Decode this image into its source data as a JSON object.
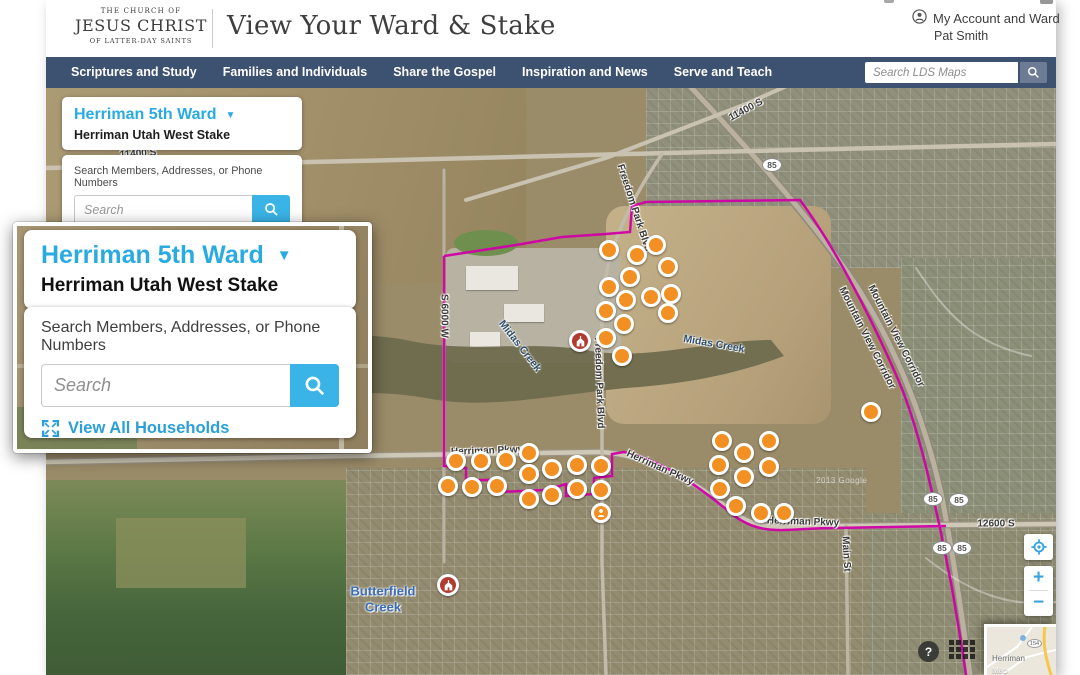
{
  "header": {
    "logo_line1": "THE CHURCH OF",
    "logo_line2": "JESUS CHRIST",
    "logo_line3": "OF LATTER-DAY SAINTS",
    "title": "View Your Ward & Stake",
    "account_label": "My Account and Ward",
    "account_user": "Pat Smith"
  },
  "nav": {
    "items": [
      "Scriptures and Study",
      "Families and Individuals",
      "Share the Gospel",
      "Inspiration and News",
      "Serve and Teach"
    ],
    "search_placeholder": "Search LDS Maps"
  },
  "panel": {
    "ward_name": "Herriman 5th Ward",
    "stake_name": "Herriman Utah West Stake",
    "search_label": "Search Members, Addresses, or Phone Numbers",
    "search_placeholder": "Search",
    "view_all_label": "View All Households"
  },
  "map": {
    "road_labels": [
      {
        "text": "11400 S",
        "x": 92,
        "y": 66,
        "rot": -4
      },
      {
        "text": "11400 S",
        "x": 700,
        "y": 22,
        "rot": -28
      },
      {
        "text": "S 6000 W",
        "x": 398,
        "y": 228,
        "rot": 90
      },
      {
        "text": "Freedom Park Blvd",
        "x": 588,
        "y": 120,
        "rot": 72
      },
      {
        "text": "Freedom Park Blvd",
        "x": 553,
        "y": 295,
        "rot": 88
      },
      {
        "text": "Herriman Pkwy",
        "x": 441,
        "y": 363,
        "rot": -2
      },
      {
        "text": "Herriman Pkwy",
        "x": 614,
        "y": 380,
        "rot": 24
      },
      {
        "text": "Herriman Pkwy",
        "x": 757,
        "y": 434,
        "rot": 2
      },
      {
        "text": "12600 S",
        "x": 950,
        "y": 436,
        "rot": 0
      },
      {
        "text": "Main St",
        "x": 800,
        "y": 466,
        "rot": 87
      },
      {
        "text": "Mountain View Corridor",
        "x": 821,
        "y": 250,
        "rot": 63
      },
      {
        "text": "Mountain View Corridor",
        "x": 850,
        "y": 248,
        "rot": 63
      }
    ],
    "water_labels": [
      {
        "text": "Midas Creek",
        "x": 474,
        "y": 258,
        "rot": 52,
        "big": false
      },
      {
        "text": "Midas Creek",
        "x": 668,
        "y": 256,
        "rot": 10,
        "big": false
      },
      {
        "text": "Butterfield",
        "x": 337,
        "y": 503,
        "rot": 0,
        "big": true
      },
      {
        "text": "Creek",
        "x": 337,
        "y": 519,
        "rot": 0,
        "big": true
      }
    ],
    "shields": [
      {
        "text": "85",
        "x": 726,
        "y": 77
      },
      {
        "text": "85",
        "x": 887,
        "y": 411
      },
      {
        "text": "85",
        "x": 913,
        "y": 412
      },
      {
        "text": "85",
        "x": 896,
        "y": 460
      },
      {
        "text": "85",
        "x": 916,
        "y": 460
      }
    ],
    "households": [
      [
        566,
        165
      ],
      [
        594,
        170
      ],
      [
        613,
        160
      ],
      [
        625,
        182
      ],
      [
        587,
        192
      ],
      [
        566,
        202
      ],
      [
        608,
        212
      ],
      [
        628,
        209
      ],
      [
        583,
        215
      ],
      [
        563,
        226
      ],
      [
        625,
        228
      ],
      [
        581,
        239
      ],
      [
        563,
        253
      ],
      [
        579,
        271
      ],
      [
        828,
        327
      ],
      [
        413,
        376
      ],
      [
        438,
        376
      ],
      [
        463,
        375
      ],
      [
        486,
        368
      ],
      [
        405,
        401
      ],
      [
        429,
        402
      ],
      [
        454,
        401
      ],
      [
        486,
        389
      ],
      [
        486,
        414
      ],
      [
        509,
        384
      ],
      [
        509,
        410
      ],
      [
        534,
        380
      ],
      [
        534,
        404
      ],
      [
        558,
        381
      ],
      [
        558,
        405
      ],
      [
        679,
        356
      ],
      [
        701,
        368
      ],
      [
        726,
        356
      ],
      [
        676,
        380
      ],
      [
        701,
        392
      ],
      [
        726,
        382
      ],
      [
        677,
        404
      ],
      [
        693,
        421
      ],
      [
        718,
        428
      ],
      [
        741,
        428
      ]
    ],
    "meetinghouses": [
      [
        537,
        256
      ],
      [
        405,
        500
      ]
    ],
    "member_marker": [
      558,
      428
    ],
    "imagery_credit": "2013 Google",
    "minimap": {
      "place": "Herriman",
      "caption": "Map",
      "shield": "154"
    },
    "controls": {
      "zoom_in": "+",
      "zoom_out": "−",
      "help": "?"
    }
  }
}
